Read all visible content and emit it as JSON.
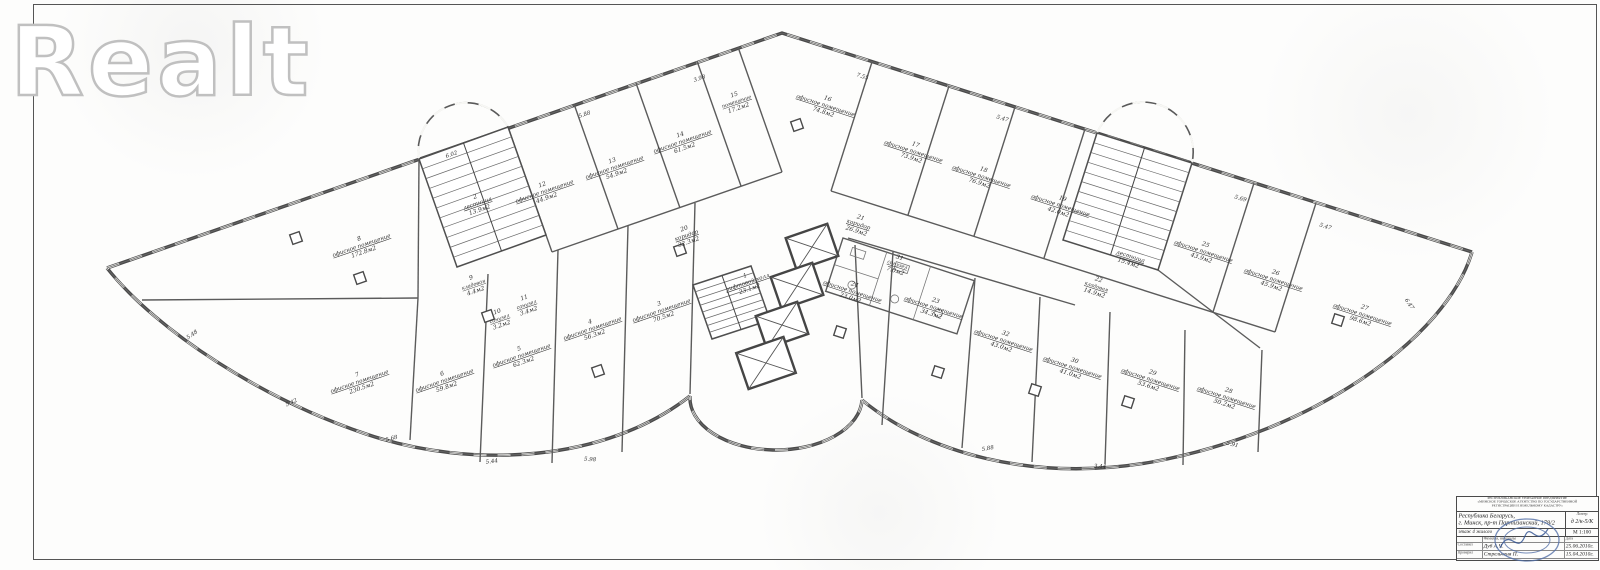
{
  "watermark": {
    "text": "Realt"
  },
  "plan": {
    "rooms": [
      {
        "id": "r1",
        "num": "1",
        "name": "лифтовой холл",
        "area": "23.1м2"
      },
      {
        "id": "r2",
        "num": "2",
        "name": "лестница",
        "area": "13.9м2"
      },
      {
        "id": "r3",
        "num": "3",
        "name": "офисное помещение",
        "area": "70.5м2"
      },
      {
        "id": "r4",
        "num": "4",
        "name": "офисное помещение",
        "area": "56.3м2"
      },
      {
        "id": "r5",
        "num": "5",
        "name": "офисное помещение",
        "area": "62.3м2"
      },
      {
        "id": "r6",
        "num": "6",
        "name": "офисное помещение",
        "area": "59.8м2"
      },
      {
        "id": "r7",
        "num": "7",
        "name": "офисное помещение",
        "area": "230.5м2"
      },
      {
        "id": "r8",
        "num": "8",
        "name": "офисное помещение",
        "area": "172.8м2"
      },
      {
        "id": "r9",
        "num": "9",
        "name": "кладовая",
        "area": "4.4м2"
      },
      {
        "id": "r10",
        "num": "10",
        "name": "санузел",
        "area": "3.2м2"
      },
      {
        "id": "r11",
        "num": "11",
        "name": "санузел",
        "area": "3.4м2"
      },
      {
        "id": "r12",
        "num": "12",
        "name": "офисное помещение",
        "area": "44.9м2"
      },
      {
        "id": "r13",
        "num": "13",
        "name": "офисное помещение",
        "area": "54.9м2"
      },
      {
        "id": "r14",
        "num": "14",
        "name": "офисное помещение",
        "area": "61.5м2"
      },
      {
        "id": "r15",
        "num": "15",
        "name": "помещение",
        "area": "17.2м2"
      },
      {
        "id": "r16",
        "num": "16",
        "name": "офисное помещение",
        "area": "74.8м2"
      },
      {
        "id": "r17",
        "num": "17",
        "name": "офисное помещение",
        "area": "73.9м2"
      },
      {
        "id": "r18",
        "num": "18",
        "name": "офисное помещение",
        "area": "76.9м2"
      },
      {
        "id": "r19",
        "num": "19",
        "name": "офисное помещение",
        "area": "42.0м2"
      },
      {
        "id": "r20",
        "num": "20",
        "name": "коридор",
        "area": "32.3м2"
      },
      {
        "id": "r21",
        "num": "21",
        "name": "коридор",
        "area": "26.9м2"
      },
      {
        "id": "r22",
        "num": "22",
        "name": "кладовая",
        "area": "14.9м2"
      },
      {
        "id": "r23",
        "num": "23",
        "name": "офисное помещение",
        "area": "34.3м2"
      },
      {
        "id": "r24",
        "num": "24",
        "name": "офисное помещение",
        "area": "23.0м2"
      },
      {
        "id": "r25",
        "num": "25",
        "name": "офисное помещение",
        "area": "43.9м2"
      },
      {
        "id": "r26",
        "num": "26",
        "name": "офисное помещение",
        "area": "45.9м2"
      },
      {
        "id": "r27",
        "num": "27",
        "name": "офисное помещение",
        "area": "98.6м2"
      },
      {
        "id": "r28",
        "num": "28",
        "name": "офисное помещение",
        "area": "50.2м2"
      },
      {
        "id": "r29",
        "num": "29",
        "name": "офисное помещение",
        "area": "53.6м2"
      },
      {
        "id": "r30",
        "num": "30",
        "name": "офисное помещение",
        "area": "41.0м2"
      },
      {
        "id": "r31",
        "num": "31",
        "name": "санузел",
        "area": "7.0м2"
      },
      {
        "id": "r32",
        "num": "32",
        "name": "офисное помещение",
        "area": "43.0м2"
      },
      {
        "id": "r33",
        "num": "",
        "name": "лестница",
        "area": "15.4м2"
      }
    ],
    "dimensions": [
      "5.48",
      "5.42",
      "5.68",
      "5.44",
      "5.98",
      "6.02",
      "5.88",
      "3.98",
      "7.55",
      "5.47",
      "5.69",
      "5.47",
      "6.47",
      "5.91",
      "3.44",
      "5.88"
    ]
  },
  "title_block": {
    "org_lines": [
      "РЕСПУБЛИКАНСКОЕ УНИТАРНОЕ ПРЕДПРИЯТИЕ",
      "«МИНСКОЕ ГОРОДСКОЕ АГЕНТСТВО ПО ГОСУДАРСТВЕННОЙ",
      "РЕГИСТРАЦИИ И ЗЕМЕЛЬНОМУ КАДАСТРУ»"
    ],
    "address_line1": "Республика Беларусь,",
    "address_line2": "г. Минск, пр-т Партизанский, 178/2",
    "liter_label": "Литер",
    "liter_value": "д 2/к-5/К",
    "floor_label": "этаж 4 жилого",
    "scale": "М 1:100",
    "name_col_header": "Фамилия, инициалы",
    "date_col_header": "Дата",
    "rows": [
      {
        "role": "Составил",
        "name": "Дуб А.Ч.",
        "date": "25.06.2010г."
      },
      {
        "role": "Проверил",
        "name": "Стрельченя П.",
        "date": "15.04.2010г."
      }
    ]
  }
}
